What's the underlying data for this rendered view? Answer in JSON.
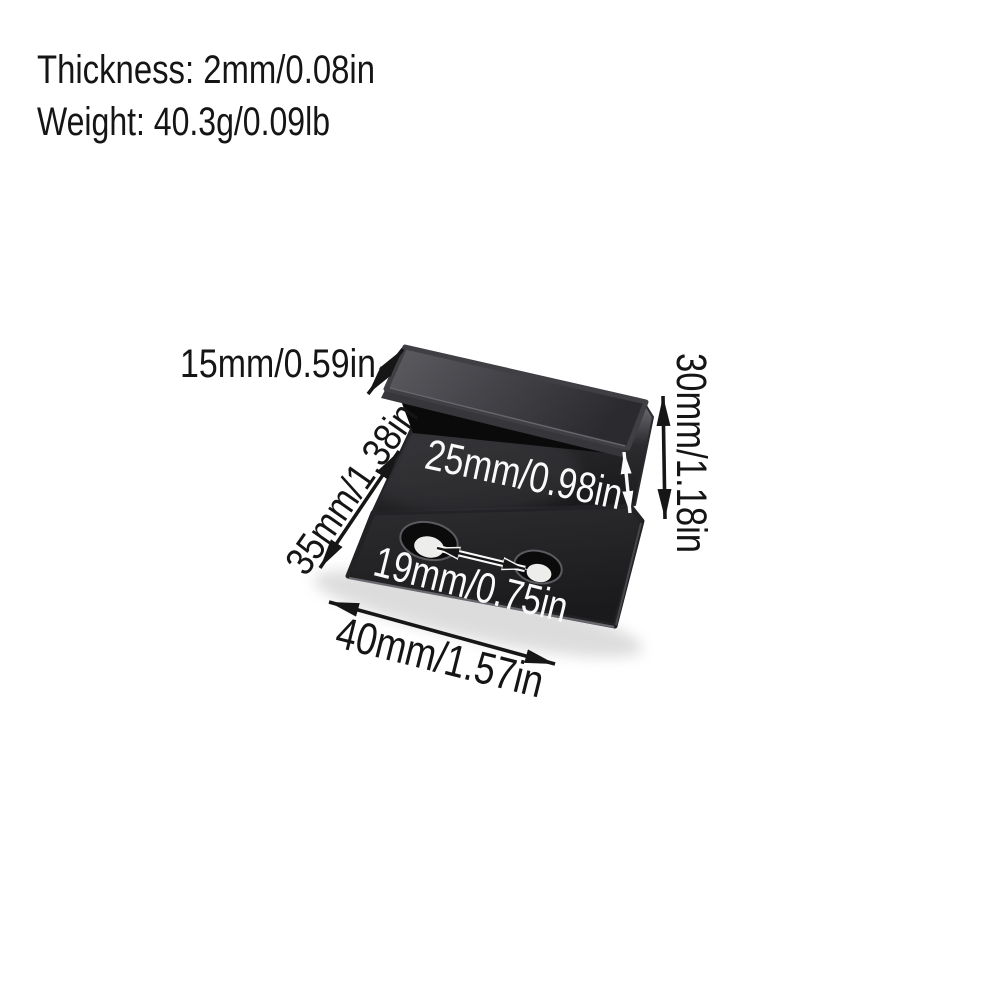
{
  "specs": {
    "thickness": "Thickness: 2mm/0.08in",
    "weight": "Weight: 40.3g/0.09lb"
  },
  "dimensions": {
    "flange_depth": "15mm/0.59in",
    "overall_height": "30mm/1.18in",
    "face_height": "25mm/0.98in",
    "side_length": "35mm/1.38in",
    "hole_spacing": "19mm/0.75in",
    "base_length": "40mm/1.57in"
  },
  "colors": {
    "background": "#ffffff",
    "metal_dark": "#1d1d1f",
    "metal_light": "#57575c",
    "annotation_black": "#151515",
    "annotation_white": "#fafafa"
  }
}
